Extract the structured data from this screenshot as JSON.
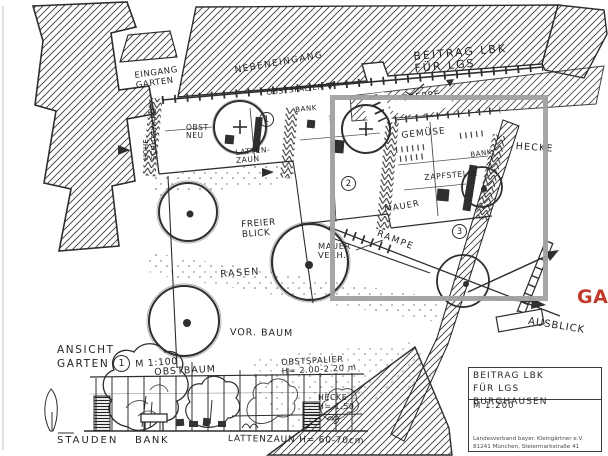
{
  "scan": {
    "description": "hand-drawn kleingarten competition site plan, scanned sketch"
  },
  "highlight": {
    "label": "GA",
    "color": "#c13a2a",
    "box_color": "#a1a1a1"
  },
  "top_note": {
    "text": "BEITRAG LBK\nFÜR LGS"
  },
  "plan": {
    "eingang": "EINGANG\nGARTEN",
    "nebeneingang": "NEBENEINGANG",
    "treppe": "TREPPE",
    "obstspalier": "OBSTSPALIER",
    "bank_p1": "BANK",
    "obst_neu": "OBST\nNEU",
    "wall_left": "HOHE\nSCHUTZWAND",
    "lattenzaun": "LATTEN-\nZAUN",
    "gemuese": "GEMÜSE",
    "zapfstelle": "ZAPFSTELLE",
    "mauer": "MAUER",
    "bank_p3": "BANK",
    "hecke": "HECKE",
    "freier_blick": "FREIER\nBLICK",
    "mauer_verh": "MAUER\nVERH.",
    "rampe": "RAMPE",
    "rasen": "RASEN",
    "vor_baum": "VOR. BAUM",
    "ausblick": "AUSBLICK",
    "parcel_1": "1",
    "parcel_2": "2",
    "parcel_3": "3"
  },
  "elevation": {
    "title_line1": "ANSICHT",
    "title_line2": "GARTEN",
    "marker": "1",
    "scale": "M 1:100",
    "obstbaum": "OBSTBAUM",
    "obstspalier": "OBSTSPALIER\nH= 2.00-2.20 m",
    "hecke": "HECKE\nH= 1.50",
    "stauden": "STAUDEN",
    "bank": "BANK",
    "lattenzaun": "LATTENZAUN  H= 60-70cm"
  },
  "titleblock": {
    "line1": "BEITRAG LBK",
    "line2": "FÜR LGS BURGHAUSEN",
    "scale": "M 1:200",
    "org_line1": "Landesverband bayer. Kleingärtner e.V.",
    "org_line2": "81241 München, Steiermarkstraße 41"
  }
}
